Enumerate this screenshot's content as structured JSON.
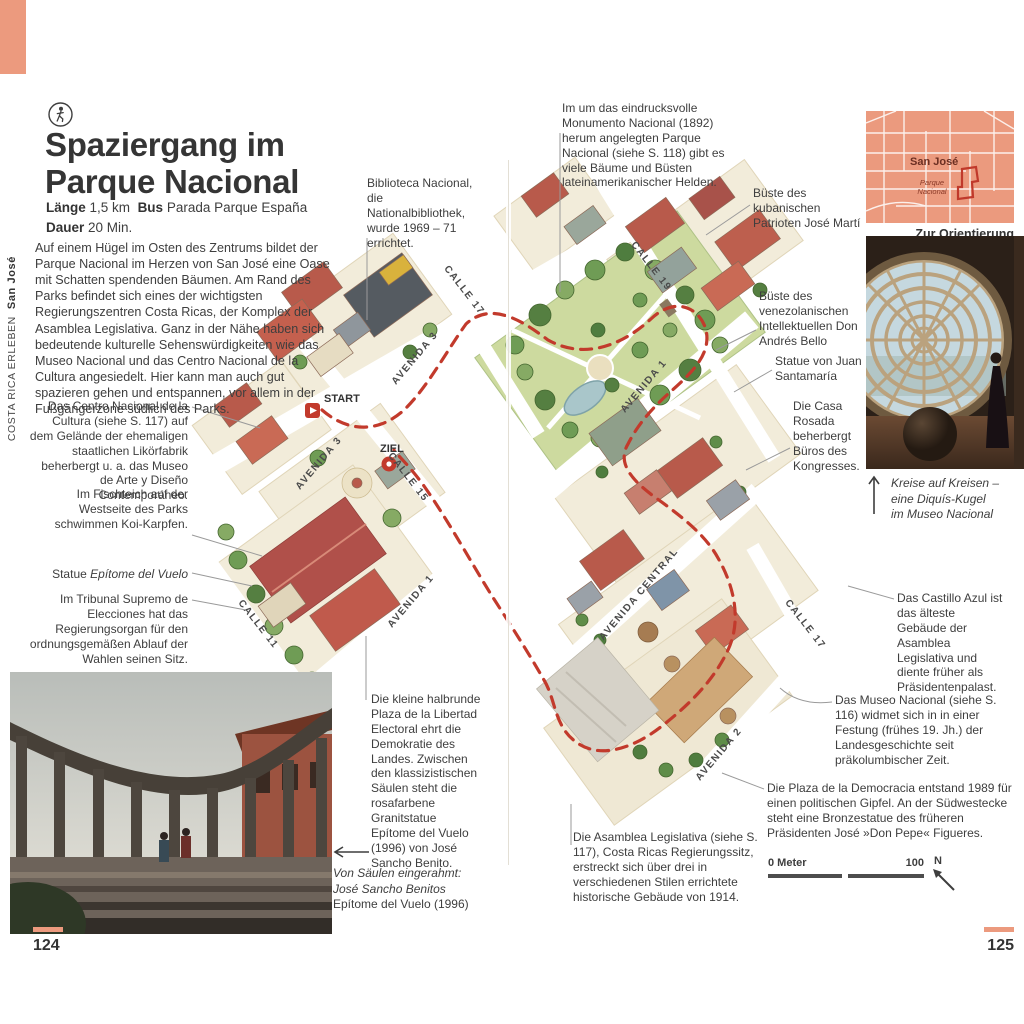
{
  "accent": "#ec9a7e",
  "sidebar": {
    "series": "COSTA RICA ERLEBEN",
    "location": "San José"
  },
  "header": {
    "icon": "walking-tour-icon",
    "title_line1": "Spaziergang im",
    "title_line2": "Parque Nacional",
    "meta_laenge_label": "Länge",
    "meta_laenge_value": "1,5 km",
    "meta_bus_label": "Bus",
    "meta_bus_value": "Parada Parque España",
    "meta_dauer_label": "Dauer",
    "meta_dauer_value": "20 Min.",
    "intro": "Auf einem Hügel im Osten des Zentrums bildet der Parque Nacional im Herzen von San José eine Oase mit Schatten spendenden Bäumen. Am Rand des Parks befindet sich eines der wichtigsten Regierungszentren Costa Ricas, der Komplex der Asamblea Legislativa. Ganz in der Nähe haben sich bedeutende kulturelle Sehenswürdigkeiten wie das Museo Nacional und das Centro Nacional de la Cultura angesiedelt. Hier kann man auch gut spazieren gehen und entspannen, vor allem in der Fußgängerzone südlich des Parks."
  },
  "annotations": {
    "biblioteca": "Biblioteca Nacional, die Nationalbibliothek, wurde 1969 – 71 errichtet.",
    "centro_cultura": "Das Centro Nacional de la Cultura (siehe S. 117) auf dem Gelände der ehemaligen staatlichen Likörfabrik beherbergt u. a. das Museo de Arte y Diseño Contemporáneo.",
    "fischteich": "Im Fischteich auf der Westseite des Parks schwimmen Koi-Karpfen.",
    "statue_label": "Statue",
    "statue_name": "Epítome del Vuelo",
    "tribunal": "Im Tribunal Supremo de Elecciones hat das Regierungsorgan für den ordnungsgemäßen Ablauf der Wahlen seinen Sitz.",
    "plaza_libertad": "Die kleine halbrunde Plaza de la Libertad Electoral ehrt die Demokratie des Landes. Zwischen den klassizistischen Säulen steht die rosafarbene Granitstatue Epítome del Vuelo (1996) von José Sancho Benito.",
    "monumento": "Im um das eindrucksvolle Monumento Nacional (1892) herum angelegten Parque Nacional (siehe S. 118) gibt es viele Bäume und Büsten lateinamerikanischer Helden.",
    "jose_marti": "Büste des kubanischen Patrioten José Martí",
    "andres_bello": "Büste des venezolanischen Intellektuellen Don Andrés Bello",
    "juan_santamaria": "Statue von Juan Santamaría",
    "casa_rosada": "Die Casa Rosada beherbergt Büros des Kongresses.",
    "castillo_azul": "Das Castillo Azul ist das älteste Gebäude der Asamblea Legislativa und diente früher als Präsidentenpalast.",
    "museo_nacional": "Das Museo Nacional (siehe S. 116) widmet sich in in einer Festung (frühes 19. Jh.) der Landesgeschichte seit präkolumbischer Zeit.",
    "plaza_democracia": "Die Plaza de la Democracia entstand 1989 für einen politischen Gipfel. An der Südwestecke steht eine Bronzestatue des früheren Präsidenten José »Don Pepe« Figueres.",
    "asamblea": "Die Asamblea Legislativa (siehe S. 117), Costa Ricas Regierungssitz, erstreckt sich über drei in verschiedenen Stilen errichtete historische Gebäude von 1914."
  },
  "map": {
    "start_label": "START",
    "ziel_label": "ZIEL",
    "streets": {
      "avenida3_a": "AVENIDA 3",
      "avenida3_b": "AVENIDA 3",
      "avenida1_left": "AVENIDA 1",
      "avenida1_right": "AVENIDA 1",
      "avenida_central": "AVENIDA CENTRAL",
      "avenida2": "AVENIDA 2",
      "calle11": "CALLE 11",
      "calle15": "CALLE 15",
      "calle17_top": "CALLE 17",
      "calle17_right": "CALLE 17",
      "calle19": "CALLE 19"
    }
  },
  "orientation": {
    "city": "San José",
    "area_line1": "Parque",
    "area_line2": "Nacional",
    "caption_title": "Zur Orientierung",
    "caption_note": "Siehe Stadtteilkarte S. 104f"
  },
  "captions": {
    "museo_photo_line1": "Kreise auf Kreisen –",
    "museo_photo_line2": "eine Diquís-Kugel",
    "museo_photo_line3": "im Museo Nacional",
    "plaza_photo_line1": "Von Säulen eingerahmt:",
    "plaza_photo_line2": "José Sancho Benitos",
    "plaza_photo_line3": "Epítome del Vuelo (1996)"
  },
  "scalebar": {
    "zero": "0 Meter",
    "hundred": "100",
    "north": "N"
  },
  "pages": {
    "left": "124",
    "right": "125"
  }
}
